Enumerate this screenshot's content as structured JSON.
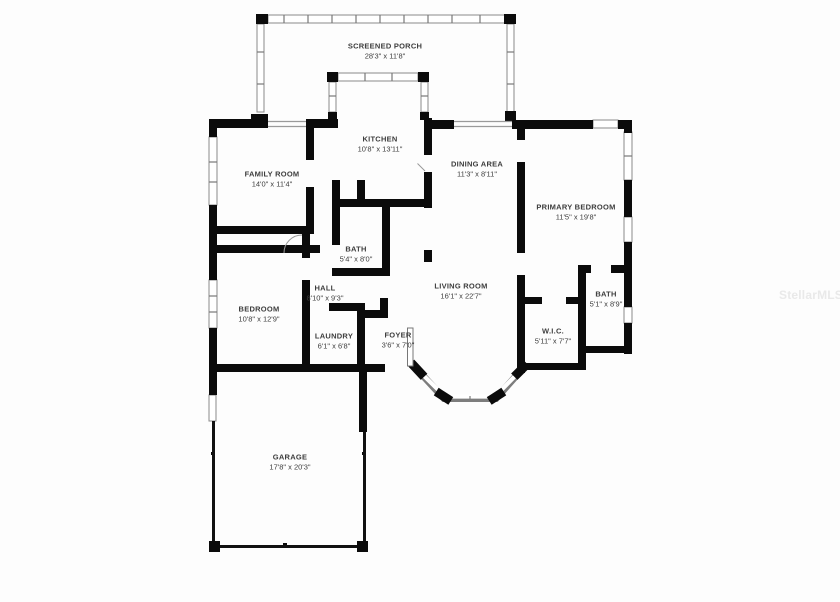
{
  "watermark": {
    "text": "StellarMLS"
  },
  "plan": {
    "rooms": [
      {
        "id": "screened-porch",
        "name": "SCREENED PORCH",
        "dims": "28'3\" x 11'8\"",
        "x": 385,
        "y": 51
      },
      {
        "id": "kitchen",
        "name": "KITCHEN",
        "dims": "10'8\" x 13'11\"",
        "x": 380,
        "y": 144
      },
      {
        "id": "dining-area",
        "name": "DINING AREA",
        "dims": "11'3\" x 8'11\"",
        "x": 477,
        "y": 169
      },
      {
        "id": "family-room",
        "name": "FAMILY ROOM",
        "dims": "14'0\" x 11'4\"",
        "x": 272,
        "y": 179
      },
      {
        "id": "primary-bedroom",
        "name": "PRIMARY BEDROOM",
        "dims": "11'5\" x 19'8\"",
        "x": 576,
        "y": 212
      },
      {
        "id": "bath",
        "name": "BATH",
        "dims": "5'4\" x 8'0\"",
        "x": 356,
        "y": 254
      },
      {
        "id": "hall",
        "name": "HALL",
        "dims": "8'10\" x 9'3\"",
        "x": 325,
        "y": 293
      },
      {
        "id": "living-room",
        "name": "LIVING ROOM",
        "dims": "16'1\" x 22'7\"",
        "x": 461,
        "y": 291
      },
      {
        "id": "bedroom",
        "name": "BEDROOM",
        "dims": "10'8\" x 12'9\"",
        "x": 259,
        "y": 314
      },
      {
        "id": "bath-2",
        "name": "BATH",
        "dims": "5'1\" x 8'9\"",
        "x": 606,
        "y": 299
      },
      {
        "id": "wic",
        "name": "W.I.C.",
        "dims": "5'11\" x 7'7\"",
        "x": 553,
        "y": 336
      },
      {
        "id": "laundry",
        "name": "LAUNDRY",
        "dims": "6'1\" x 6'8\"",
        "x": 334,
        "y": 341
      },
      {
        "id": "foyer",
        "name": "FOYER",
        "dims": "3'6\" x 7'0\"",
        "x": 398,
        "y": 340
      },
      {
        "id": "garage",
        "name": "GARAGE",
        "dims": "17'8\" x 20'3\"",
        "x": 290,
        "y": 462
      }
    ]
  }
}
